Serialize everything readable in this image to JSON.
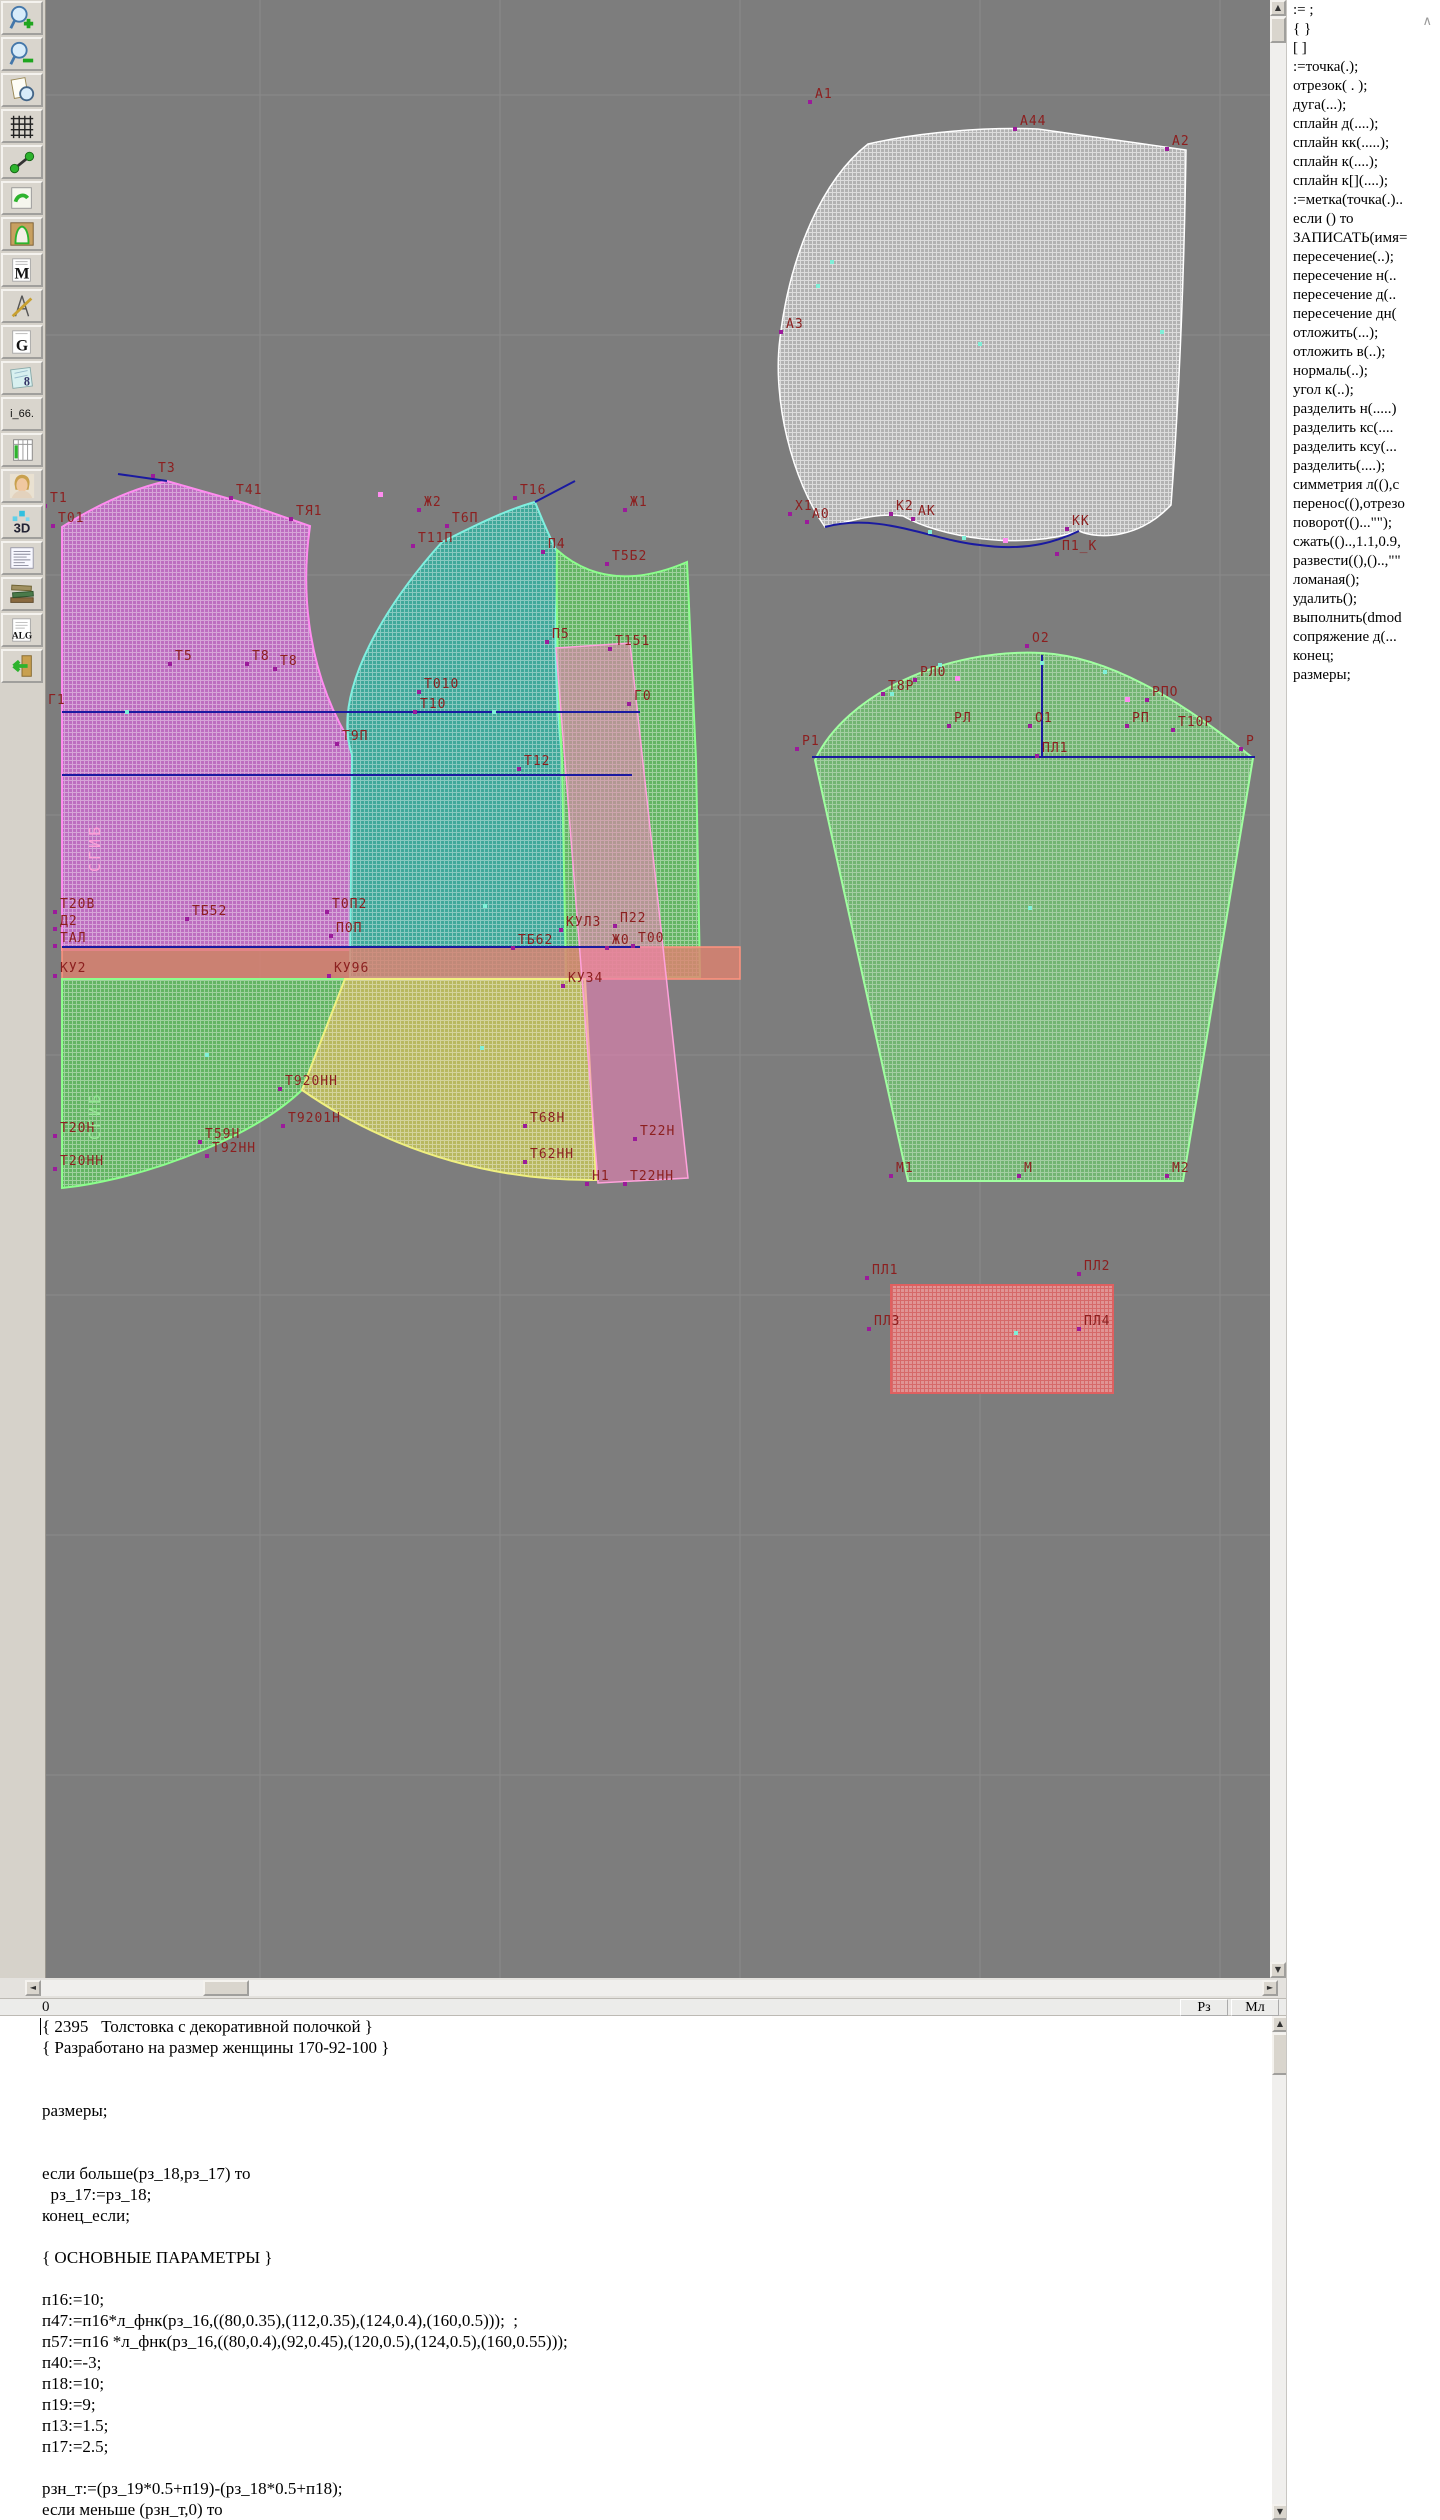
{
  "toolbar": {
    "icons": [
      {
        "name": "zoom-in-icon"
      },
      {
        "name": "zoom-out-icon"
      },
      {
        "name": "preview-icon"
      },
      {
        "name": "grid-icon"
      },
      {
        "name": "measure-icon"
      },
      {
        "name": "sketch-icon"
      },
      {
        "name": "pattern-piece-icon"
      },
      {
        "name": "m-document-icon"
      },
      {
        "name": "construct-icon"
      },
      {
        "name": "g-document-icon"
      },
      {
        "name": "sizes-document-icon"
      },
      {
        "name": "i66-button",
        "label": "i_66."
      },
      {
        "name": "table-icon"
      },
      {
        "name": "portrait-icon"
      },
      {
        "name": "3d-icon"
      },
      {
        "name": "text-list-icon"
      },
      {
        "name": "books-icon"
      },
      {
        "name": "alg-document-icon"
      },
      {
        "name": "exit-icon"
      }
    ]
  },
  "command_panel": {
    "scroll_hint": "∧",
    "items": [
      ":= ;",
      "{  }",
      "[  ]",
      ":=точка(.);",
      "отрезок( . );",
      "дуга(...);",
      "сплайн  д(....);",
      "сплайн  кк(.....);",
      "сплайн  к(....);",
      "сплайн  к[](....);",
      ":=метка(точка(.)..",
      "если () то",
      "ЗАПИСАТЬ(имя=",
      "пересечение(..);",
      "пересечение  н(..",
      "пересечение  д(..",
      "пересечение  дн(",
      "отложить(...);",
      "отложить  в(..);",
      "нормаль(..);",
      "угол  к(..);",
      "разделить  н(.....)",
      "разделить  кс(....",
      "разделить  ксу(...",
      "разделить(....);",
      "симметрия  л((),с",
      "перенос((),отрезо",
      "поворот(()...\"\");",
      "сжать(()..,1.1,0.9,",
      "развести((),()..,\"\"",
      "ломаная();",
      "удалить();",
      "выполнить(dmod",
      "сопряжение  д(...",
      "конец;",
      "размеры;"
    ]
  },
  "scrollbars": {
    "up": "▲",
    "down": "▼",
    "left": "◄",
    "right": "►"
  },
  "status_row": {
    "line_number": "0",
    "buttons": [
      {
        "label": "Рз"
      },
      {
        "label": "Мл"
      }
    ]
  },
  "editor": {
    "lines": [
      "{ 2395   Толстовка с декоративной полочкой }",
      "{ Разработано на размер женщины 170-92-100 }",
      "",
      "",
      "размеры;",
      "",
      "",
      "если больше(рз_18,рз_17) то",
      "  рз_17:=рз_18;",
      "конец_если;",
      "",
      "{ ОСНОВНЫЕ ПАРАМЕТРЫ }",
      "",
      "п16:=10;",
      "п47:=п16*л_фнк(рз_16,((80,0.35),(112,0.35),(124,0.4),(160,0.5)));  ;",
      "п57:=п16 *л_фнк(рз_16,((80,0.4),(92,0.45),(120,0.5),(124,0.5),(160,0.55)));",
      "п40:=-3;",
      "п18:=10;",
      "п19:=9;",
      "п13:=1.5;",
      "п17:=2.5;",
      "",
      "рзн_т:=(рз_19*0.5+п19)-(рз_18*0.5+п18);",
      "если меньше (рзн_т,0) то"
    ]
  },
  "canvas": {
    "labels": [
      {
        "t": "Т1",
        "x": 50,
        "y": 492
      },
      {
        "t": "Т01",
        "x": 58,
        "y": 512
      },
      {
        "t": "Т3",
        "x": 158,
        "y": 462
      },
      {
        "t": "Т41",
        "x": 236,
        "y": 484
      },
      {
        "t": "ТЯ1",
        "x": 296,
        "y": 505
      },
      {
        "t": "Ж2",
        "x": 424,
        "y": 496
      },
      {
        "t": "Т6П",
        "x": 452,
        "y": 512
      },
      {
        "t": "Т16",
        "x": 520,
        "y": 484
      },
      {
        "t": "Т11П",
        "x": 418,
        "y": 532
      },
      {
        "t": "Ж1",
        "x": 630,
        "y": 496
      },
      {
        "t": "Х1",
        "x": 795,
        "y": 500
      },
      {
        "t": "П4",
        "x": 548,
        "y": 538
      },
      {
        "t": "Т5Б2",
        "x": 612,
        "y": 550
      },
      {
        "t": "П5",
        "x": 552,
        "y": 628
      },
      {
        "t": "Т151",
        "x": 615,
        "y": 635
      },
      {
        "t": "Т5",
        "x": 175,
        "y": 650
      },
      {
        "t": "Т8",
        "x": 252,
        "y": 650
      },
      {
        "t": "Т8",
        "x": 280,
        "y": 655
      },
      {
        "t": "Г1",
        "x": 48,
        "y": 694
      },
      {
        "t": "Т010",
        "x": 424,
        "y": 678
      },
      {
        "t": "Т10",
        "x": 420,
        "y": 698
      },
      {
        "t": "Т9П",
        "x": 342,
        "y": 730
      },
      {
        "t": "Т12",
        "x": 524,
        "y": 755
      },
      {
        "t": "Г0",
        "x": 634,
        "y": 690
      },
      {
        "t": "Т20В",
        "x": 60,
        "y": 898
      },
      {
        "t": "Д2",
        "x": 60,
        "y": 915
      },
      {
        "t": "ТАЛ",
        "x": 60,
        "y": 932
      },
      {
        "t": "КУ2",
        "x": 60,
        "y": 962
      },
      {
        "t": "ТБ52",
        "x": 192,
        "y": 905
      },
      {
        "t": "Т0П2",
        "x": 332,
        "y": 898
      },
      {
        "t": "П0П",
        "x": 336,
        "y": 922
      },
      {
        "t": "КУ96",
        "x": 334,
        "y": 962
      },
      {
        "t": "КУЛ3",
        "x": 566,
        "y": 916
      },
      {
        "t": "П22",
        "x": 620,
        "y": 912
      },
      {
        "t": "ТБ62",
        "x": 518,
        "y": 934
      },
      {
        "t": "Ж0",
        "x": 612,
        "y": 934
      },
      {
        "t": "Т00",
        "x": 638,
        "y": 932
      },
      {
        "t": "КУ34",
        "x": 568,
        "y": 972
      },
      {
        "t": "Т20Н",
        "x": 60,
        "y": 1122
      },
      {
        "t": "Т20НН",
        "x": 60,
        "y": 1155
      },
      {
        "t": "Т59Н",
        "x": 205,
        "y": 1128
      },
      {
        "t": "Т92НН",
        "x": 212,
        "y": 1142
      },
      {
        "t": "Т920НН",
        "x": 285,
        "y": 1075
      },
      {
        "t": "Т9201Н",
        "x": 288,
        "y": 1112
      },
      {
        "t": "Т68Н",
        "x": 530,
        "y": 1112
      },
      {
        "t": "Т62НН",
        "x": 530,
        "y": 1148
      },
      {
        "t": "Т22Н",
        "x": 640,
        "y": 1125
      },
      {
        "t": "Н1",
        "x": 592,
        "y": 1170
      },
      {
        "t": "Т22НН",
        "x": 630,
        "y": 1170
      },
      {
        "t": "А1",
        "x": 815,
        "y": 88
      },
      {
        "t": "А44",
        "x": 1020,
        "y": 115
      },
      {
        "t": "А2",
        "x": 1172,
        "y": 135
      },
      {
        "t": "А3",
        "x": 786,
        "y": 318
      },
      {
        "t": "А0",
        "x": 812,
        "y": 508
      },
      {
        "t": "К2",
        "x": 896,
        "y": 500
      },
      {
        "t": "АК",
        "x": 918,
        "y": 505
      },
      {
        "t": "КК",
        "x": 1072,
        "y": 515
      },
      {
        "t": "П1_К",
        "x": 1062,
        "y": 540
      },
      {
        "t": "О2",
        "x": 1032,
        "y": 632
      },
      {
        "t": "Т8Р",
        "x": 888,
        "y": 680
      },
      {
        "t": "РЛ0",
        "x": 920,
        "y": 666
      },
      {
        "t": "РПО",
        "x": 1152,
        "y": 686
      },
      {
        "t": "РЛ",
        "x": 954,
        "y": 712
      },
      {
        "t": "О1",
        "x": 1035,
        "y": 712
      },
      {
        "t": "РП",
        "x": 1132,
        "y": 712
      },
      {
        "t": "Т10Р",
        "x": 1178,
        "y": 716
      },
      {
        "t": "Р1",
        "x": 802,
        "y": 735
      },
      {
        "t": "ПЛ1",
        "x": 1042,
        "y": 742
      },
      {
        "t": "Р",
        "x": 1246,
        "y": 735
      },
      {
        "t": "М1",
        "x": 896,
        "y": 1162
      },
      {
        "t": "М",
        "x": 1024,
        "y": 1162
      },
      {
        "t": "М2",
        "x": 1172,
        "y": 1162
      },
      {
        "t": "ПЛ1",
        "x": 872,
        "y": 1264
      },
      {
        "t": "ПЛ2",
        "x": 1084,
        "y": 1260
      },
      {
        "t": "ПЛ3",
        "x": 874,
        "y": 1315
      },
      {
        "t": "ПЛ4",
        "x": 1084,
        "y": 1315
      }
    ],
    "fold_labels": [
      {
        "t": "СГИБ",
        "x": 86,
        "y": 872,
        "c": "#ff9fd8"
      },
      {
        "t": "СГИБ",
        "x": 86,
        "y": 1140,
        "c": "#96e896"
      }
    ],
    "cyan_markers": [
      [
        125,
        710
      ],
      [
        492,
        710
      ],
      [
        483,
        904
      ],
      [
        205,
        1053
      ],
      [
        480,
        1046
      ],
      [
        830,
        260
      ],
      [
        816,
        284
      ],
      [
        928,
        530
      ],
      [
        962,
        536
      ],
      [
        978,
        342
      ],
      [
        1160,
        330
      ],
      [
        1040,
        661
      ],
      [
        938,
        663
      ],
      [
        1103,
        670
      ],
      [
        890,
        692
      ],
      [
        1028,
        906
      ],
      [
        1014,
        1331
      ]
    ],
    "pink_markers": [
      [
        955,
        676
      ],
      [
        1125,
        697
      ],
      [
        1003,
        538
      ],
      [
        378,
        492
      ]
    ],
    "colors": {
      "background": "#7d7d7d",
      "grid_line": "#8a8a8a",
      "label": "#8c1f1f",
      "point_marker": "#9b1b9b",
      "back_piece": "#bd6ec0",
      "front_piece": "#3fa89a",
      "side_piece": "#63b463",
      "lower_piece": "#b8b860",
      "waistband": "#dd8270",
      "pink_strip": "#f282b9",
      "hood_piece": "#b2b2b2",
      "sleeve_piece": "#72b472",
      "pocket_rect": "#e09494",
      "construction_line": "#1a1aa0"
    }
  }
}
